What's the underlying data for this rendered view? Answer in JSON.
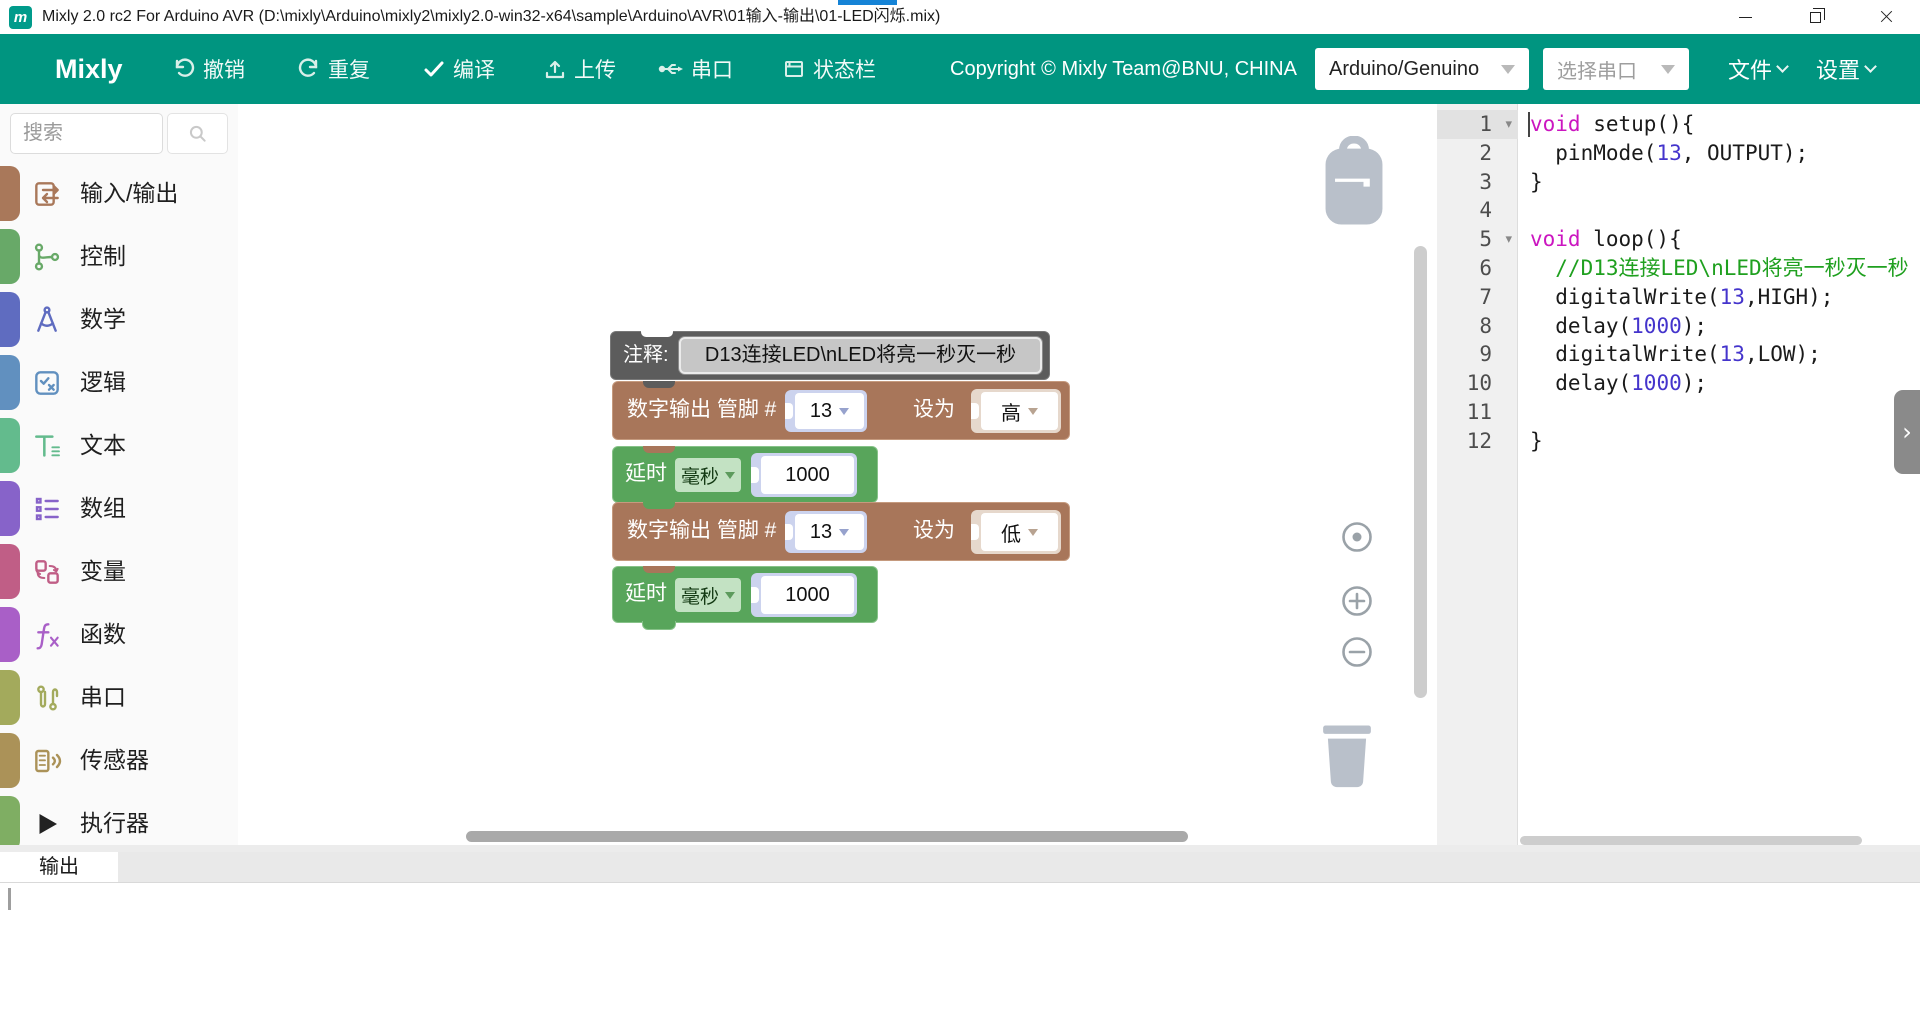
{
  "window": {
    "title": "Mixly 2.0 rc2 For Arduino AVR (D:\\mixly\\Arduino\\mixly2\\mixly2.0-win32-x64\\sample\\Arduino\\AVR\\01输入-输出\\01-LED闪烁.mix)",
    "logo_letter": "m"
  },
  "theme": {
    "toolbar_teal": "#009580",
    "loading_blue": "#1583d6"
  },
  "toolbar": {
    "brand": "Mixly",
    "buttons": [
      {
        "id": "undo",
        "label": "撤销"
      },
      {
        "id": "redo",
        "label": "重复"
      },
      {
        "id": "compile",
        "label": "编译"
      },
      {
        "id": "upload",
        "label": "上传"
      },
      {
        "id": "serial",
        "label": "串口"
      },
      {
        "id": "statusbar",
        "label": "状态栏"
      }
    ],
    "copyright": "Copyright © Mixly Team@BNU, CHINA",
    "board_select": "Arduino/Genuino",
    "port_select": "选择串口",
    "menu_file": "文件",
    "menu_settings": "设置"
  },
  "sidebar": {
    "search_placeholder": "搜索",
    "categories": [
      {
        "label": "输入/输出",
        "color": "#a9785a",
        "icon": "io-icon"
      },
      {
        "label": "控制",
        "color": "#68a968",
        "icon": "control-icon"
      },
      {
        "label": "数学",
        "color": "#5f6cc0",
        "icon": "math-icon"
      },
      {
        "label": "逻辑",
        "color": "#6190bf",
        "icon": "logic-icon"
      },
      {
        "label": "文本",
        "color": "#63bb8d",
        "icon": "text-icon"
      },
      {
        "label": "数组",
        "color": "#8763c9",
        "icon": "array-icon"
      },
      {
        "label": "变量",
        "color": "#c05e86",
        "icon": "variable-icon"
      },
      {
        "label": "函数",
        "color": "#a95fc7",
        "icon": "function-icon"
      },
      {
        "label": "串口",
        "color": "#a3aa5c",
        "icon": "serial-icon"
      },
      {
        "label": "传感器",
        "color": "#ab9258",
        "icon": "sensor-icon"
      },
      {
        "label": "执行器",
        "color": "#7fae63",
        "icon": "actuator-icon"
      }
    ]
  },
  "blocks": {
    "comment": {
      "label": "注释:",
      "value": "D13连接LED\\nLED将亮一秒灭一秒"
    },
    "digital1": {
      "prefix": "数字输出 管脚 #",
      "pin": "13",
      "set_label": "设为",
      "level": "高"
    },
    "delay1": {
      "label": "延时",
      "unit": "毫秒",
      "value": "1000"
    },
    "digital2": {
      "prefix": "数字输出 管脚 #",
      "pin": "13",
      "set_label": "设为",
      "level": "低"
    },
    "delay2": {
      "label": "延时",
      "unit": "毫秒",
      "value": "1000"
    }
  },
  "code_panel": {
    "lines": [
      {
        "num": "1",
        "fold": true,
        "active": true,
        "segs": [
          [
            "kw",
            "void"
          ],
          [
            "pl",
            " setup(){"
          ]
        ]
      },
      {
        "num": "2",
        "fold": false,
        "active": false,
        "segs": [
          [
            "pl",
            "  pinMode("
          ],
          [
            "num",
            "13"
          ],
          [
            "pl",
            ", OUTPUT);"
          ]
        ]
      },
      {
        "num": "3",
        "fold": false,
        "active": false,
        "segs": [
          [
            "pl",
            "}"
          ]
        ]
      },
      {
        "num": "4",
        "fold": false,
        "active": false,
        "segs": []
      },
      {
        "num": "5",
        "fold": true,
        "active": false,
        "segs": [
          [
            "kw",
            "void"
          ],
          [
            "pl",
            " loop(){"
          ]
        ]
      },
      {
        "num": "6",
        "fold": false,
        "active": false,
        "segs": [
          [
            "cm",
            "  //D13连接LED\\nLED将亮一秒灭一秒"
          ]
        ]
      },
      {
        "num": "7",
        "fold": false,
        "active": false,
        "segs": [
          [
            "pl",
            "  digitalWrite("
          ],
          [
            "num",
            "13"
          ],
          [
            "pl",
            ",HIGH);"
          ]
        ]
      },
      {
        "num": "8",
        "fold": false,
        "active": false,
        "segs": [
          [
            "pl",
            "  delay("
          ],
          [
            "num",
            "1000"
          ],
          [
            "pl",
            ");"
          ]
        ]
      },
      {
        "num": "9",
        "fold": false,
        "active": false,
        "segs": [
          [
            "pl",
            "  digitalWrite("
          ],
          [
            "num",
            "13"
          ],
          [
            "pl",
            ",LOW);"
          ]
        ]
      },
      {
        "num": "10",
        "fold": false,
        "active": false,
        "segs": [
          [
            "pl",
            "  delay("
          ],
          [
            "num",
            "1000"
          ],
          [
            "pl",
            ");"
          ]
        ]
      },
      {
        "num": "11",
        "fold": false,
        "active": false,
        "segs": []
      },
      {
        "num": "12",
        "fold": false,
        "active": false,
        "segs": [
          [
            "pl",
            "}"
          ]
        ]
      }
    ]
  },
  "bottom": {
    "tab": "输出"
  }
}
